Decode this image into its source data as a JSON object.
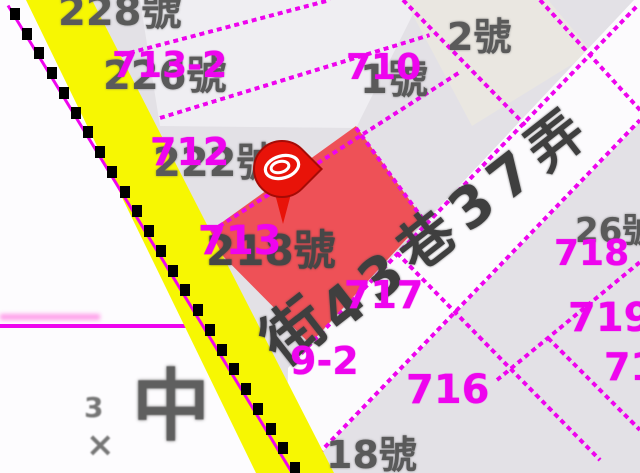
{
  "map": {
    "title": "cadastral parcel map viewer",
    "colors": {
      "boundary_magenta": "#ee04ee",
      "parcel_label_magenta": "#e005df",
      "house_label_grey": "#5a5a5a",
      "street_text_grey": "#3f3f3f",
      "road_yellow": "#f7f702",
      "selected_parcel_red": "#ee5157",
      "pin_red": "#e81309",
      "base_parcel_grey": "#e3e1e6",
      "street_band_white": "#fcfbfd"
    },
    "labels": [
      {
        "t": "228號",
        "k": "house",
        "x": 58,
        "y": -8,
        "s": 40
      },
      {
        "t": "713-2",
        "k": "parcel",
        "x": 112,
        "y": 48,
        "s": 36
      },
      {
        "t": "226號",
        "k": "house",
        "x": 103,
        "y": 56,
        "s": 40
      },
      {
        "t": "712",
        "k": "parcel",
        "x": 150,
        "y": 133,
        "s": 38
      },
      {
        "t": "222號",
        "k": "house",
        "x": 153,
        "y": 143,
        "s": 40
      },
      {
        "t": "713",
        "k": "parcel",
        "x": 198,
        "y": 221,
        "s": 40
      },
      {
        "t": "218號",
        "k": "house-dark",
        "x": 206,
        "y": 230,
        "s": 42
      },
      {
        "t": "710",
        "k": "parcel",
        "x": 346,
        "y": 50,
        "s": 36
      },
      {
        "t": "1號",
        "k": "house",
        "x": 360,
        "y": 60,
        "s": 40
      },
      {
        "t": "2號",
        "k": "house",
        "x": 447,
        "y": 18,
        "s": 38
      },
      {
        "t": "717",
        "k": "parcel",
        "x": 344,
        "y": 276,
        "s": 38
      },
      {
        "t": "716",
        "k": "parcel",
        "x": 406,
        "y": 370,
        "s": 40
      },
      {
        "t": "718",
        "k": "parcel",
        "x": 554,
        "y": 236,
        "s": 36
      },
      {
        "t": "26號",
        "k": "house",
        "x": 575,
        "y": 214,
        "s": 34
      },
      {
        "t": "719",
        "k": "parcel",
        "x": 568,
        "y": 298,
        "s": 40
      },
      {
        "t": "71",
        "k": "parcel",
        "x": 604,
        "y": 348,
        "s": 38
      },
      {
        "t": "9-2",
        "k": "parcel",
        "x": 290,
        "y": 342,
        "s": 38
      },
      {
        "t": "街",
        "k": "street",
        "x": 270,
        "y": 320,
        "s": 62,
        "r": -38
      },
      {
        "t": "43巷37弄",
        "k": "street",
        "x": 328,
        "y": 292,
        "s": 56,
        "r": -38,
        "ls": 10
      },
      {
        "t": "中",
        "k": "landmark",
        "x": 132,
        "y": 368,
        "s": 78
      },
      {
        "t": "3",
        "k": "landmark-sm",
        "x": 84,
        "y": 394,
        "s": 28
      },
      {
        "t": "×",
        "k": "landmark-sm",
        "x": 86,
        "y": 428,
        "s": 34
      },
      {
        "t": "18號",
        "k": "house",
        "x": 326,
        "y": 436,
        "s": 38
      }
    ],
    "boundary_segments": [
      [
        95,
        62,
        330,
        0
      ],
      [
        160,
        118,
        430,
        35
      ],
      [
        204,
        236,
        460,
        72
      ],
      [
        295,
        360,
        638,
        5
      ],
      [
        300,
        473,
        640,
        120
      ],
      [
        497,
        380,
        640,
        262
      ],
      [
        403,
        0,
        525,
        125
      ],
      [
        540,
        0,
        640,
        110
      ],
      [
        356,
        128,
        425,
        222
      ],
      [
        397,
        253,
        600,
        460
      ],
      [
        548,
        338,
        640,
        430
      ]
    ],
    "solid_lines": [
      {
        "x": 0,
        "y": 324,
        "w": 190,
        "h": 4
      }
    ],
    "fuzzy_lines": [
      {
        "x": 0,
        "y": 314,
        "w": 100,
        "h": 6
      }
    ],
    "road_dashes": {
      "x1": 10,
      "y1": 8,
      "x2": 290,
      "y2": 462,
      "count": 24
    }
  }
}
